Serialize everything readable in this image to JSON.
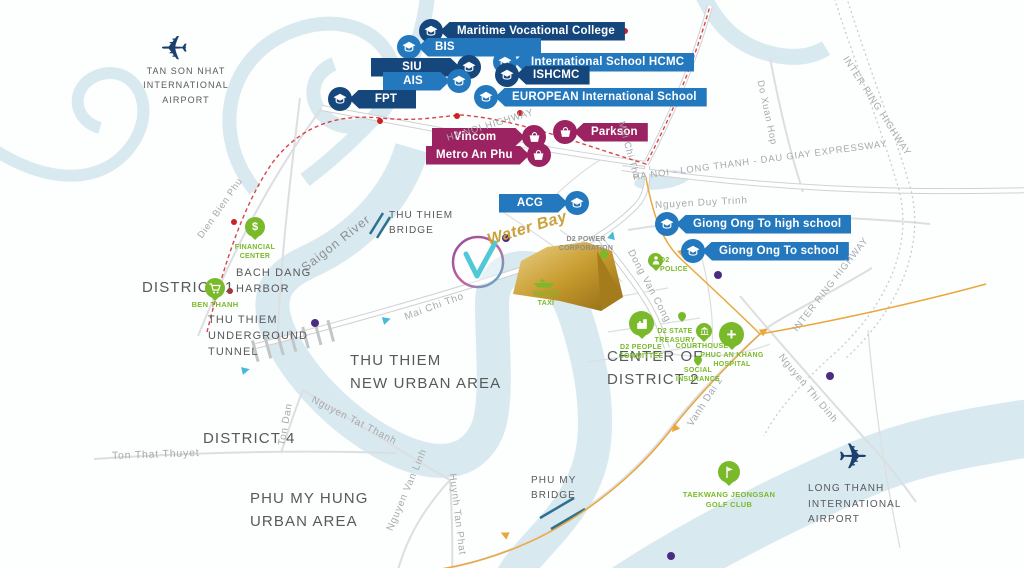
{
  "project": {
    "name": "Water Bay"
  },
  "palette": {
    "navy": "#16477c",
    "blue": "#2478bd",
    "magenta": "#9c2361",
    "green": "#7ab929",
    "gold": "#c9a23c",
    "river": "#d8e9f0",
    "metro_red": "#d8454b",
    "route_orange": "#eaa73c",
    "route_cyan": "#49b9da",
    "purple_stop": "#4c2c80",
    "area_text": "#58595b",
    "road_text": "#a7a9ac"
  },
  "icons": {
    "education": "graduation-cap-icon",
    "shopping": "basket-icon",
    "airport": "plane-icon",
    "finance": "dollar-icon",
    "market": "cart-icon",
    "police": "person-icon",
    "committee": "building-icon",
    "courthouse": "courthouse-icon",
    "hospital": "plus-icon",
    "golf": "golf-flag-icon",
    "boat": "boat-icon"
  },
  "banners": [
    {
      "label": "Maritime Vocational College",
      "category": "education",
      "color": "navy"
    },
    {
      "label": "BIS",
      "category": "education",
      "color": "blue"
    },
    {
      "label": "SIU",
      "category": "education",
      "color": "navy"
    },
    {
      "label": "International School HCMC",
      "category": "education",
      "color": "blue"
    },
    {
      "label": "AIS",
      "category": "education",
      "color": "blue"
    },
    {
      "label": "ISHCMC",
      "category": "education",
      "color": "navy"
    },
    {
      "label": "FPT",
      "category": "education",
      "color": "navy"
    },
    {
      "label": "EUROPEAN International School",
      "category": "education",
      "color": "blue"
    },
    {
      "label": "ACG",
      "category": "education",
      "color": "blue"
    },
    {
      "label": "Giong Ong To high school",
      "category": "education",
      "color": "blue"
    },
    {
      "label": "Giong Ong To school",
      "category": "education",
      "color": "blue"
    },
    {
      "label": "Vincom",
      "category": "shopping",
      "color": "magenta"
    },
    {
      "label": "Parkson",
      "category": "shopping",
      "color": "magenta"
    },
    {
      "label": "Metro An Phu",
      "category": "shopping",
      "color": "magenta"
    }
  ],
  "areas": [
    {
      "label": "TAN SON NHAT\nINTERNATIONAL\nAIRPORT"
    },
    {
      "label": "DISTRICT 1"
    },
    {
      "label": "BACH DANG\nHARBOR"
    },
    {
      "label": "THU THIEM\nUNDERGROUND\nTUNNEL"
    },
    {
      "label": "THU THIEM\nBRIDGE"
    },
    {
      "label": "THU THIEM\nNEW URBAN AREA"
    },
    {
      "label": "DISTRICT 4"
    },
    {
      "label": "PHU MY HUNG\nURBAN AREA"
    },
    {
      "label": "CENTER OF\nDISTRICT 2"
    },
    {
      "label": "PHU MY\nBRIDGE"
    },
    {
      "label": "LONG THANH\nINTERNATIONAL\nAIRPORT"
    }
  ],
  "roads": [
    {
      "name": "Dien Bien Phu"
    },
    {
      "name": "HA NOI HIGHWAY"
    },
    {
      "name": "HA NOI - LONG THANH - DAU GIAY EXPRESSWAY"
    },
    {
      "name": "INTER RING HIGHWAY"
    },
    {
      "name": "INTER RING HIGHWAY"
    },
    {
      "name": "Do Xuan Hop"
    },
    {
      "name": "Mai Chi Tho"
    },
    {
      "name": "Nguyen Duy Trinh"
    },
    {
      "name": "Mai Chi Tho"
    },
    {
      "name": "Dong Van Cong"
    },
    {
      "name": "Vanh Dai 2"
    },
    {
      "name": "Nguyen Thi Dinh"
    },
    {
      "name": "Nguyen Tat Thanh"
    },
    {
      "name": "Ton Dan"
    },
    {
      "name": "Ton That Thuyet"
    },
    {
      "name": "Nguyen Van Linh"
    },
    {
      "name": "Huynh Tan Phat"
    }
  ],
  "waterways": {
    "river_label": "Saigon River"
  },
  "pois": [
    {
      "label": "FINANCIAL\nCENTER"
    },
    {
      "label": "BEN THANH"
    },
    {
      "label": "WATER\nTAXI"
    },
    {
      "label": "D2 POWER\nCORPORATION"
    },
    {
      "label": "D2\nPOLICE"
    },
    {
      "label": "D2 PEOPLE\nCOMMITTEE"
    },
    {
      "label": "D2 STATE\nTREASURY"
    },
    {
      "label": "COURTHOUSE"
    },
    {
      "label": "PHUC AN KHANG\nHOSPITAL"
    },
    {
      "label": "SOCIAL\nINSURANCE"
    },
    {
      "label": "TAEKWANG JEONGSAN\nGOLF CLUB"
    }
  ]
}
